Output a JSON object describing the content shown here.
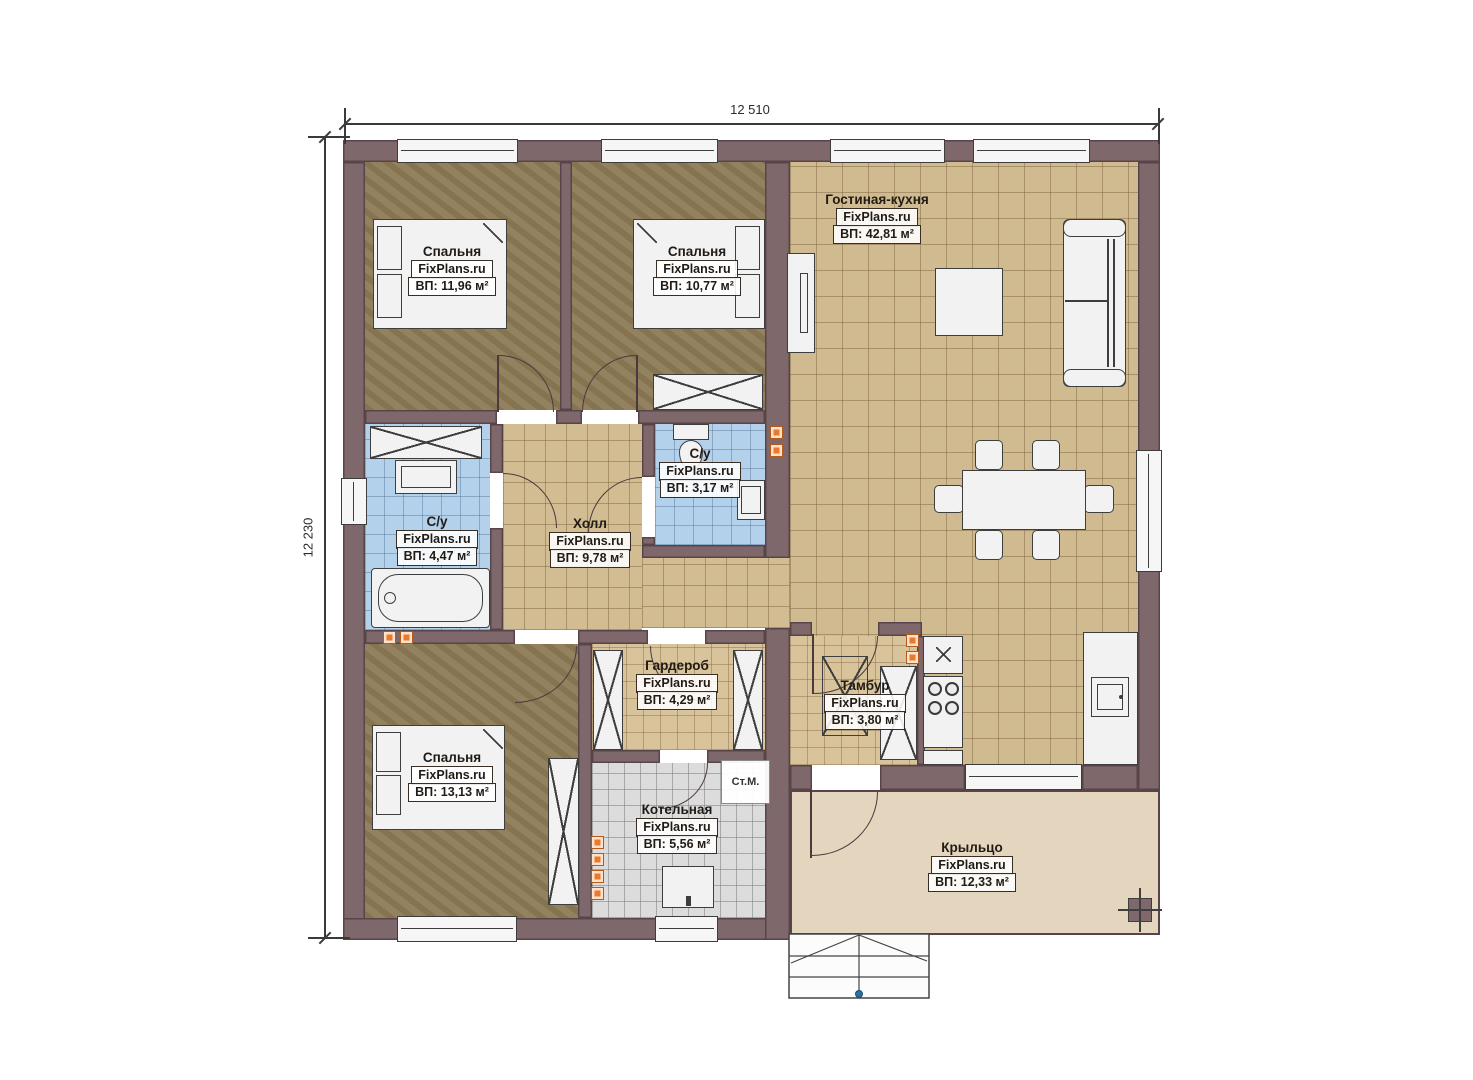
{
  "plan": {
    "dimensions": {
      "width_label": "12 510",
      "height_label": "12 230"
    },
    "rooms": [
      {
        "key": "bedroom-1",
        "name": "Спальня",
        "watermark": "FixPlans.ru",
        "area": "ВП: 11,96 м²"
      },
      {
        "key": "bedroom-2",
        "name": "Спальня",
        "watermark": "FixPlans.ru",
        "area": "ВП: 10,77 м²"
      },
      {
        "key": "living-kitchen",
        "name": "Гостиная-кухня",
        "watermark": "FixPlans.ru",
        "area": "ВП: 42,81 м²"
      },
      {
        "key": "bathroom-small",
        "name": "С/у",
        "watermark": "FixPlans.ru",
        "area": "ВП: 3,17 м²"
      },
      {
        "key": "bathroom",
        "name": "С/у",
        "watermark": "FixPlans.ru",
        "area": "ВП: 4,47 м²"
      },
      {
        "key": "hall",
        "name": "Холл",
        "watermark": "FixPlans.ru",
        "area": "ВП: 9,78 м²"
      },
      {
        "key": "wardrobe",
        "name": "Гардероб",
        "watermark": "FixPlans.ru",
        "area": "ВП: 4,29 м²"
      },
      {
        "key": "tambour",
        "name": "Тамбур",
        "watermark": "FixPlans.ru",
        "area": "ВП: 3,80 м²"
      },
      {
        "key": "bedroom-3",
        "name": "Спальня",
        "watermark": "FixPlans.ru",
        "area": "ВП: 13,13 м²"
      },
      {
        "key": "boiler-room",
        "name": "Котельная",
        "watermark": "FixPlans.ru",
        "area": "ВП: 5,56 м²"
      },
      {
        "key": "porch",
        "name": "Крыльцо",
        "watermark": "FixPlans.ru",
        "area": "ВП: 12,33 м²"
      }
    ],
    "annotations": {
      "washing_machine": "Ст.М."
    },
    "colors": {
      "wall": "#7f686b",
      "floor_bedroom": "#8d7b57",
      "floor_tile": "#d0ba90",
      "floor_bath": "#b4d1ec",
      "floor_boiler": "#dcdcdc",
      "floor_porch": "#e4d6be",
      "vent": "#e8792f"
    }
  }
}
